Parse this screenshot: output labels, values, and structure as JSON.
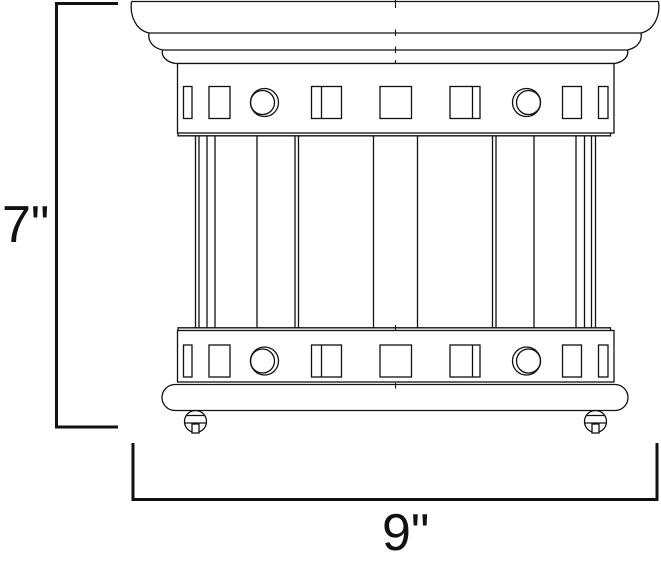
{
  "dimensions": {
    "height": {
      "label": "7\"",
      "value": 7
    },
    "width": {
      "label": "9\"",
      "value": 9
    }
  },
  "colors": {
    "ink": "#111111",
    "background": "#ffffff"
  }
}
